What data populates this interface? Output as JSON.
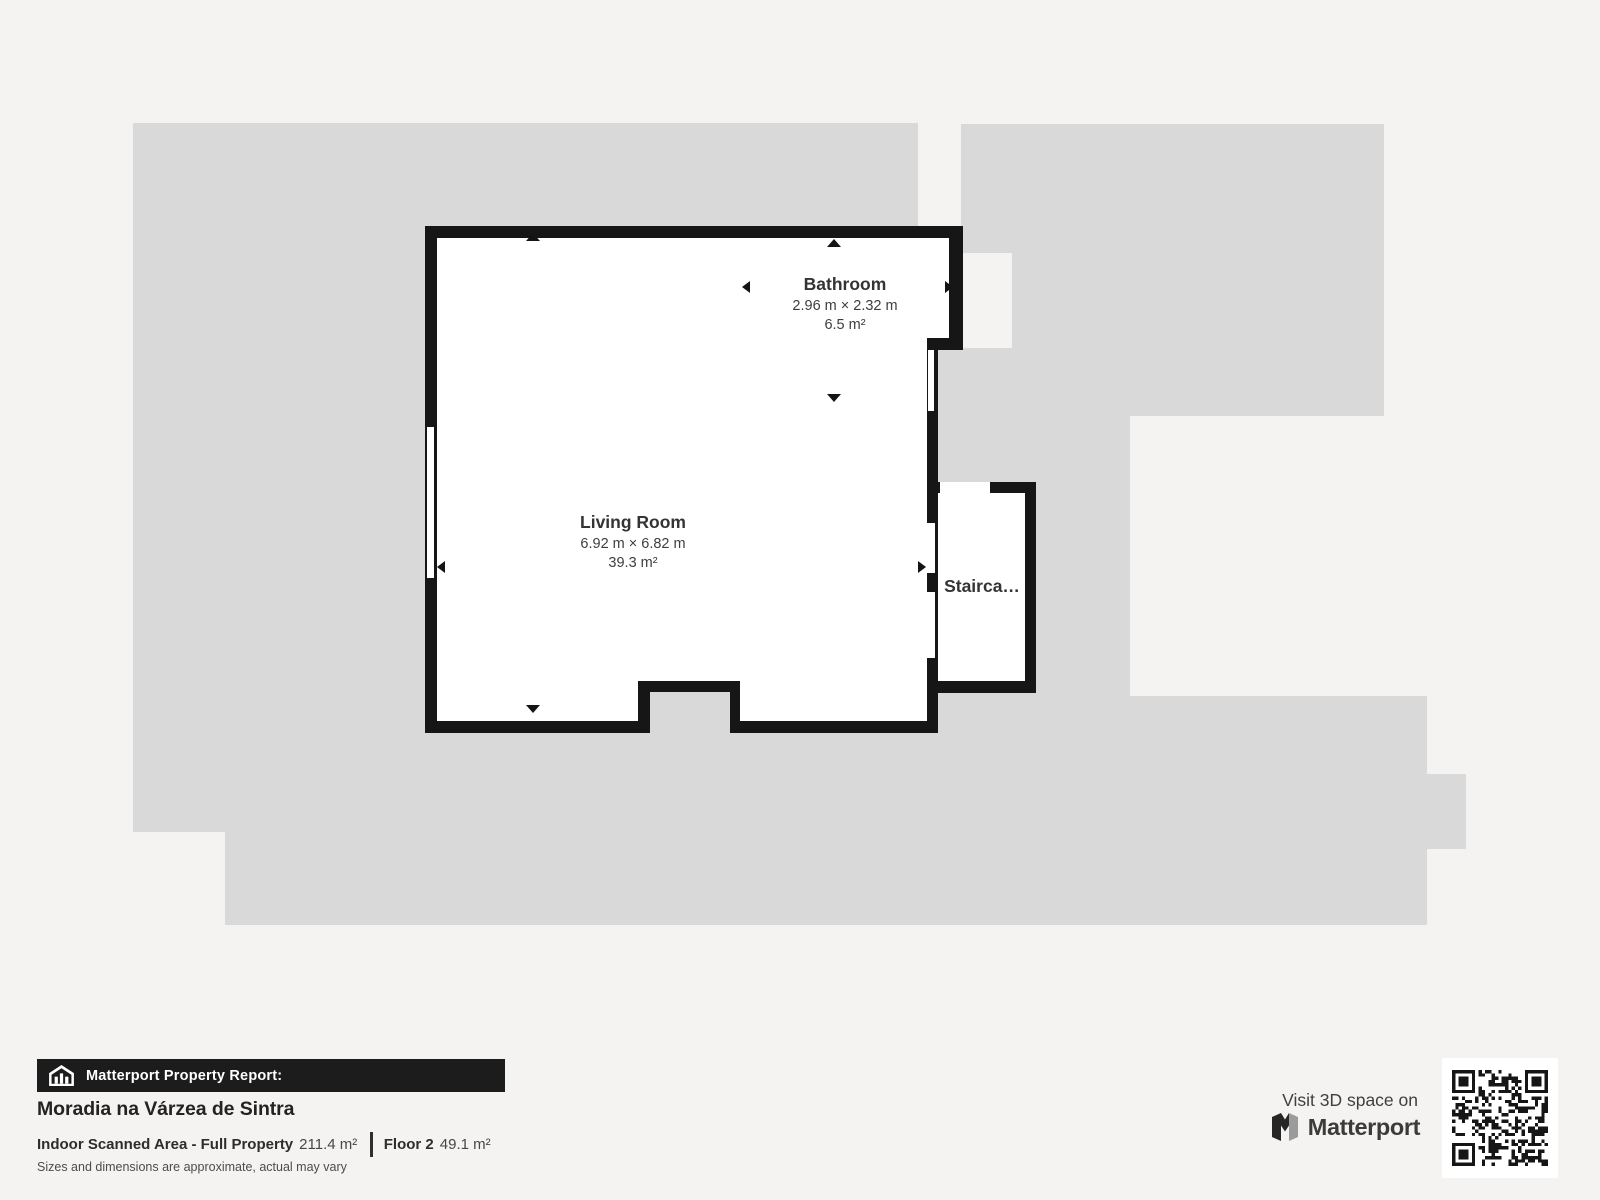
{
  "plan": {
    "rooms": {
      "living_room": {
        "name": "Living Room",
        "dimensions": "6.92 m × 6.82 m",
        "area": "39.3 m²"
      },
      "bathroom": {
        "name": "Bathroom",
        "dimensions": "2.96 m × 2.32 m",
        "area": "6.5 m²"
      },
      "staircase": {
        "name": "Stairca…"
      }
    }
  },
  "report": {
    "banner_label": "Matterport Property Report:",
    "property_name": "Moradia na Várzea de Sintra",
    "scanned_area_label": "Indoor Scanned Area - Full Property",
    "scanned_area_value": "211.4 m²",
    "floor_label": "Floor 2",
    "floor_value": "49.1 m²",
    "disclaimer": "Sizes and dimensions are approximate, actual may vary"
  },
  "promo": {
    "visit_label": "Visit 3D space on",
    "brand": "Matterport"
  },
  "colors": {
    "background": "#f4f3f1",
    "underlay": "#d9d9d9",
    "wall": "#161616",
    "banner": "#1c1c1c"
  },
  "icons": {
    "banner": "house-report-icon",
    "brand": "matterport-m-icon",
    "qr": "qr-code"
  }
}
